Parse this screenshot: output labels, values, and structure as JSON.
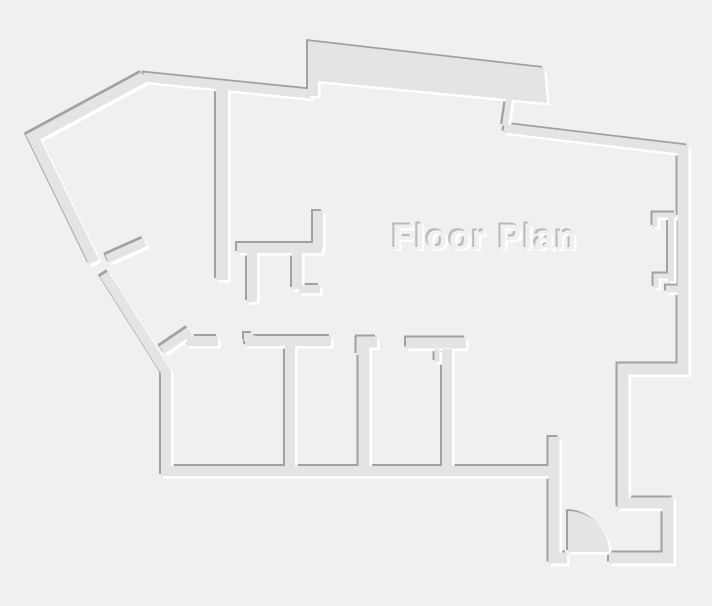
{
  "title": "Floor Plan",
  "colors": {
    "background": "#f0f0f1",
    "wall_fill": "#e3e5e5",
    "edge_dark": "#a0a2a2",
    "edge_light": "#ffffff",
    "text_fill": "#eff1f1",
    "text_shadow_dark": "#b7baba",
    "text_shadow_light": "#ffffff"
  }
}
